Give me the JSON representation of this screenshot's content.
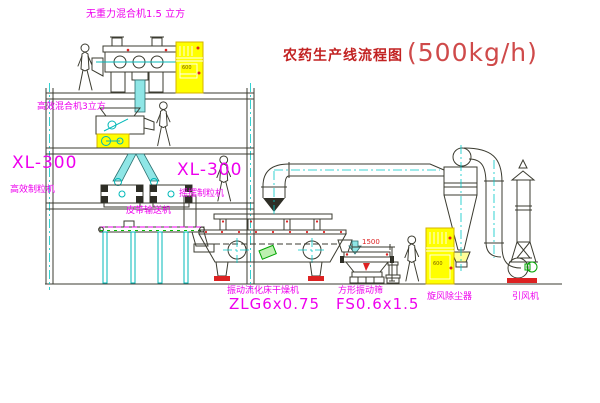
{
  "title": {
    "main": "农药生产线流程图",
    "capacity": "(500kg/h)"
  },
  "labels": {
    "gravity_mixer": "无重力混合机1.5 立方",
    "high_efficiency_mixer": "高效混合机3立方",
    "granulator_left_model": "XL-300",
    "granulator_left_name": "高效制粒机",
    "granulator_mid_model": "XL-300",
    "granulator_mid_name": "摇摆制粒机",
    "belt_conveyor": "皮带输送机",
    "dryer_name": "振动流化床干燥机",
    "dryer_model": "ZLG6x0.75",
    "sieve_name": "方形振动筛",
    "sieve_model": "FS0.6x1.5",
    "cyclone": "旋风除尘器",
    "induced_draft_fan": "引风机"
  },
  "dimensions": {
    "sieve_length": "1500"
  },
  "cabinets": {
    "panel_text_1": "600",
    "panel_text_2": "600"
  },
  "colors": {
    "label_magenta": "#ee00ee",
    "title_red": "#c22222",
    "line": "#3b3b30",
    "centerline_cyan": "#00c8c8",
    "cabinet_yellow": "#ffff00",
    "accent_red": "#dd2222",
    "accent_green": "#00a400"
  }
}
